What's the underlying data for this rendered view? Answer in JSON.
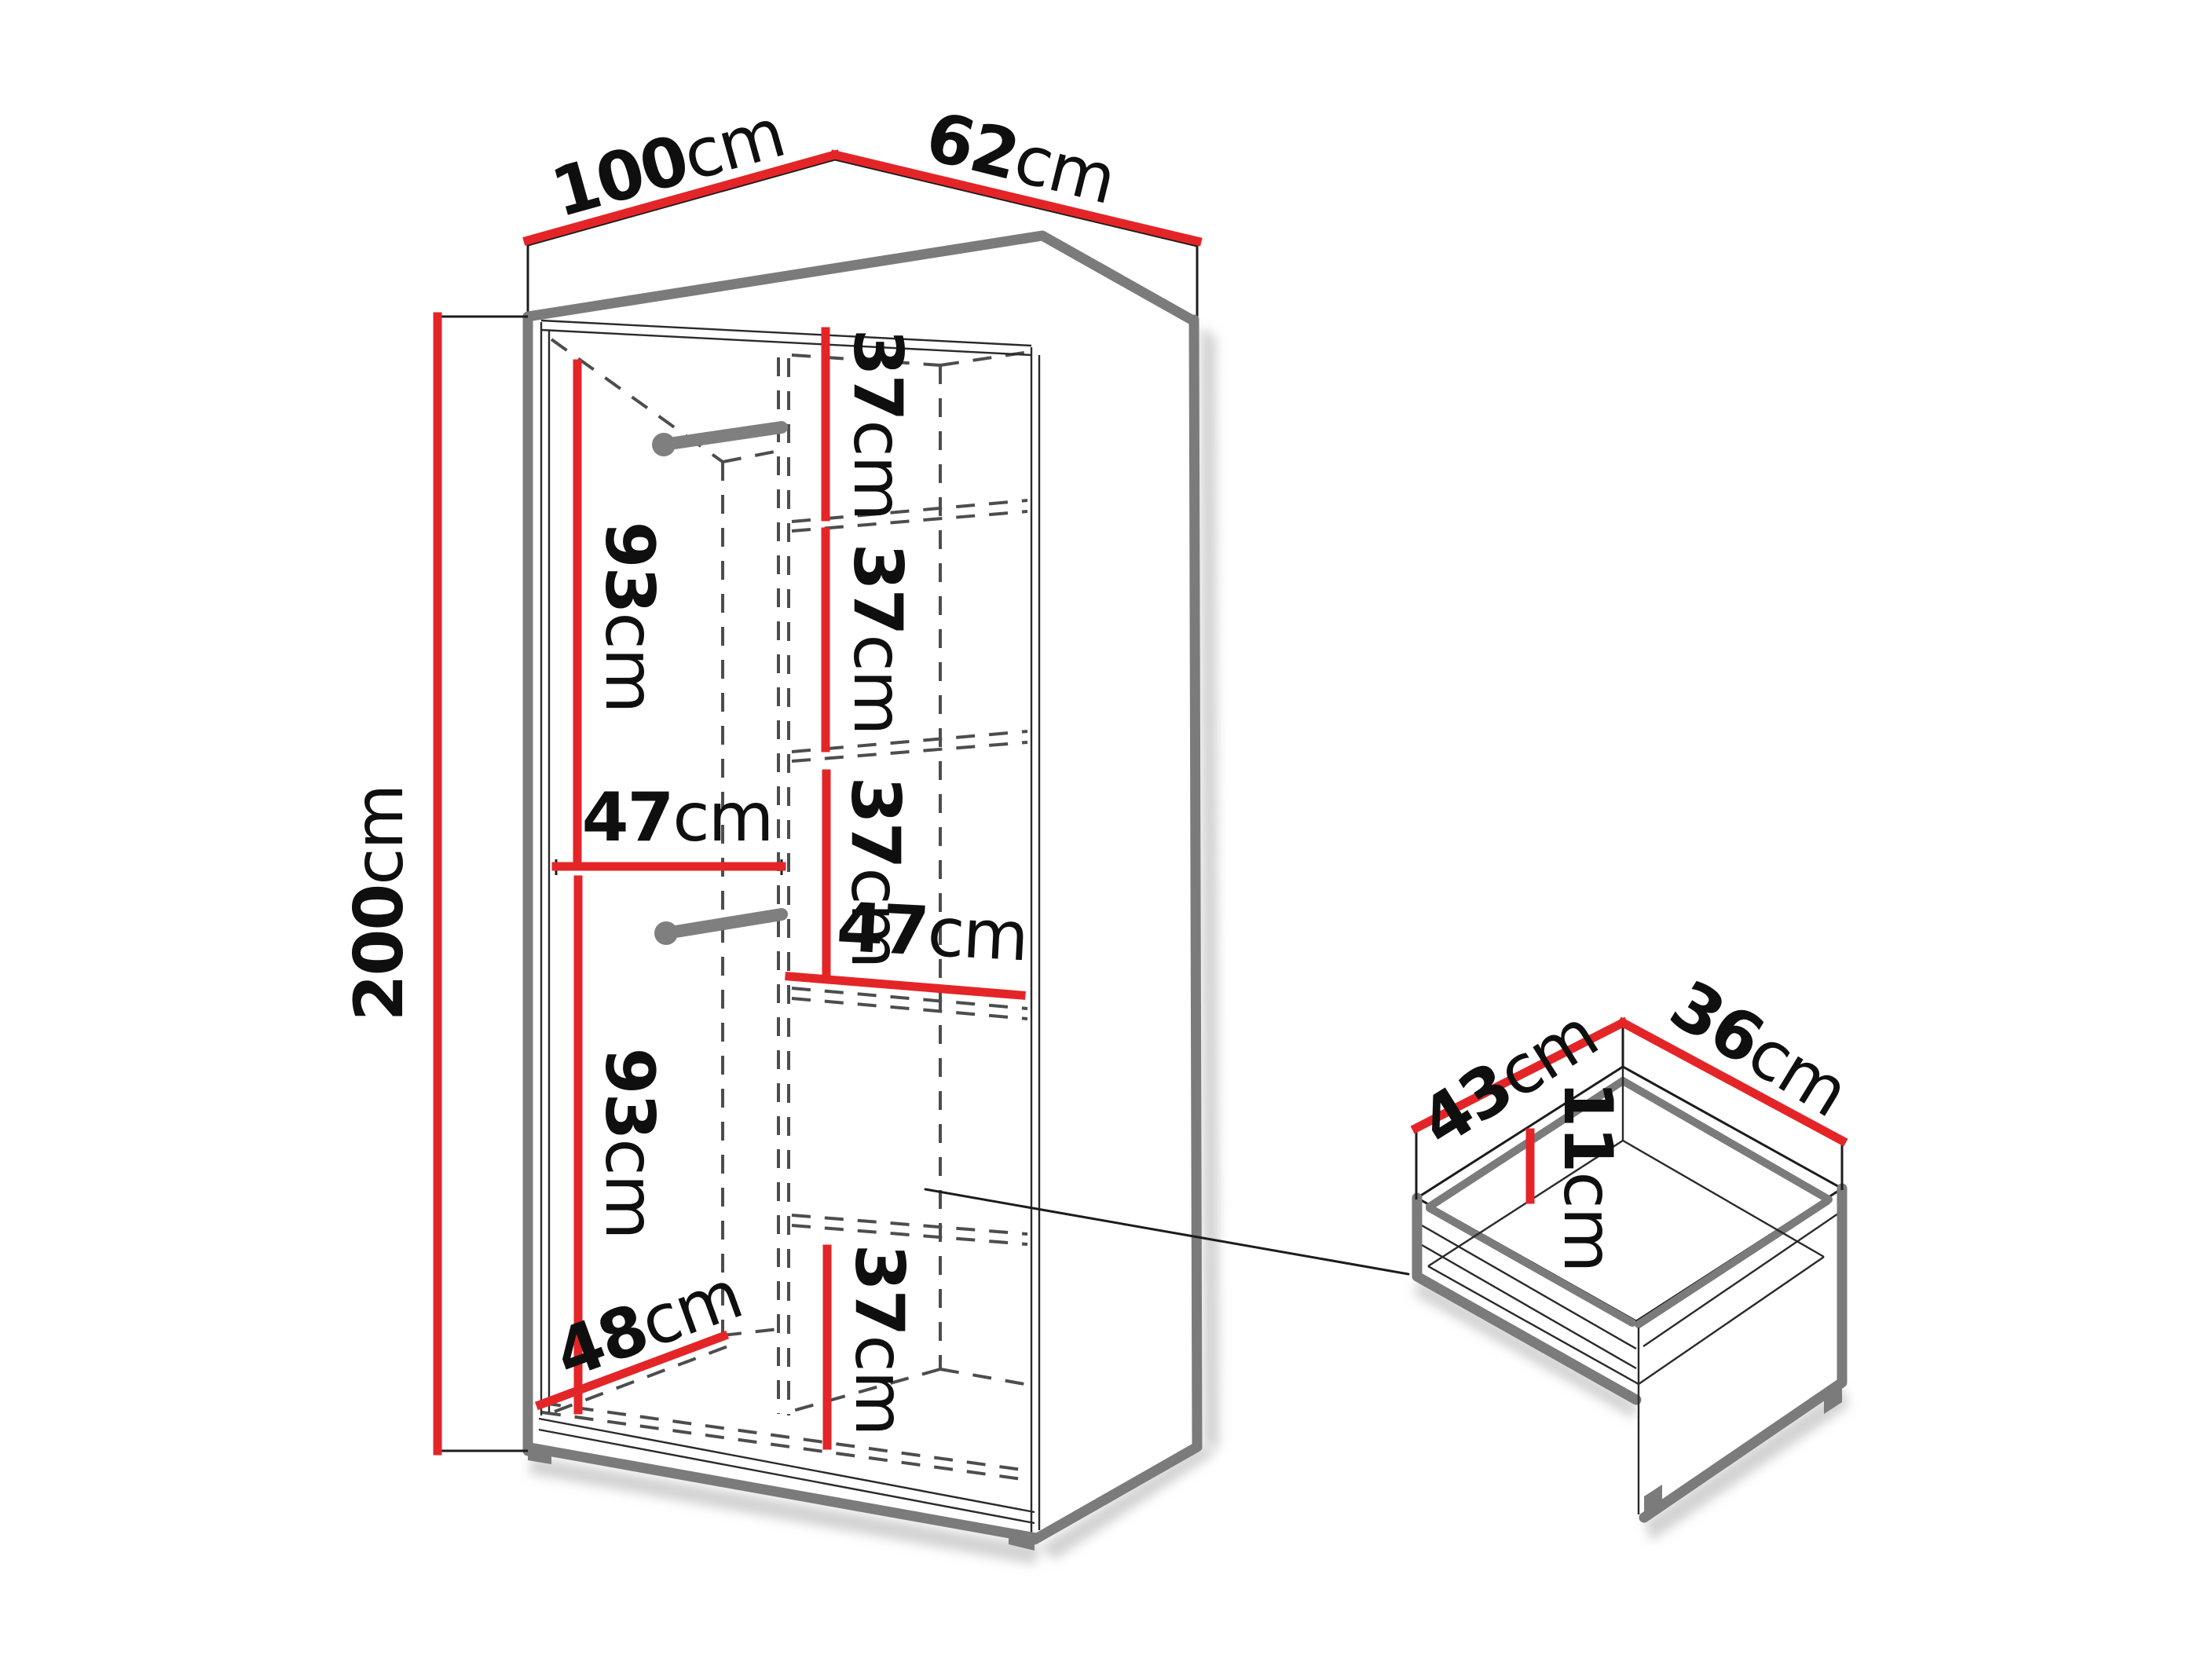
{
  "diagram_type": "furniture-dimension-diagram",
  "colors": {
    "dimension_red": "#e42528",
    "structure_gray": "#7b7b7b",
    "dashed_gray": "#4d4d4d",
    "text_black": "#0f0f0f",
    "background": "#ffffff"
  },
  "wardrobe": {
    "width": {
      "value": "100",
      "unit": "cm"
    },
    "depth": {
      "value": "62",
      "unit": "cm"
    },
    "height": {
      "value": "200",
      "unit": "cm"
    },
    "left_column": {
      "hanging_upper": {
        "value": "93",
        "unit": "cm"
      },
      "inner_width": {
        "value": "47",
        "unit": "cm"
      },
      "hanging_lower": {
        "value": "93",
        "unit": "cm"
      },
      "floor_depth": {
        "value": "48",
        "unit": "cm"
      }
    },
    "right_column": {
      "shelf_gap_1": {
        "value": "37",
        "unit": "cm"
      },
      "shelf_gap_2": {
        "value": "37",
        "unit": "cm"
      },
      "shelf_gap_3": {
        "value": "37",
        "unit": "cm"
      },
      "shelf_width": {
        "value": "47",
        "unit": "cm"
      },
      "shelf_gap_bottom": {
        "value": "37",
        "unit": "cm"
      }
    }
  },
  "drawer": {
    "depth": {
      "value": "43",
      "unit": "cm"
    },
    "width": {
      "value": "36",
      "unit": "cm"
    },
    "height": {
      "value": "11",
      "unit": "cm"
    }
  }
}
